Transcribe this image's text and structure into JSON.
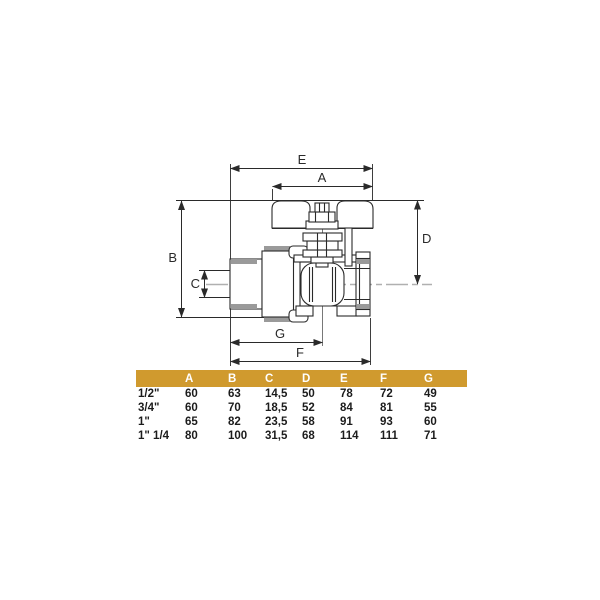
{
  "drawing": {
    "labels": {
      "A": "A",
      "B": "B",
      "C": "C",
      "D": "D",
      "E": "E",
      "F": "F",
      "G": "G"
    },
    "line_color": "#2a2a2a",
    "thread_shading_color": "#9a9a9a",
    "centerline_color": "#b0b0b0"
  },
  "table": {
    "header_bg": "#d09a2e",
    "header_text_color": "#ffffff",
    "columns": [
      "A",
      "B",
      "C",
      "D",
      "E",
      "F",
      "G"
    ],
    "rows": [
      {
        "size": "1/2\"",
        "values": [
          "60",
          "63",
          "14,5",
          "50",
          "78",
          "72",
          "49"
        ]
      },
      {
        "size": "3/4\"",
        "values": [
          "60",
          "70",
          "18,5",
          "52",
          "84",
          "81",
          "55"
        ]
      },
      {
        "size": "1\"",
        "values": [
          "65",
          "82",
          "23,5",
          "58",
          "91",
          "93",
          "60"
        ]
      },
      {
        "size": "1\" 1/4",
        "values": [
          "80",
          "100",
          "31,5",
          "68",
          "114",
          "111",
          "71"
        ]
      }
    ]
  }
}
